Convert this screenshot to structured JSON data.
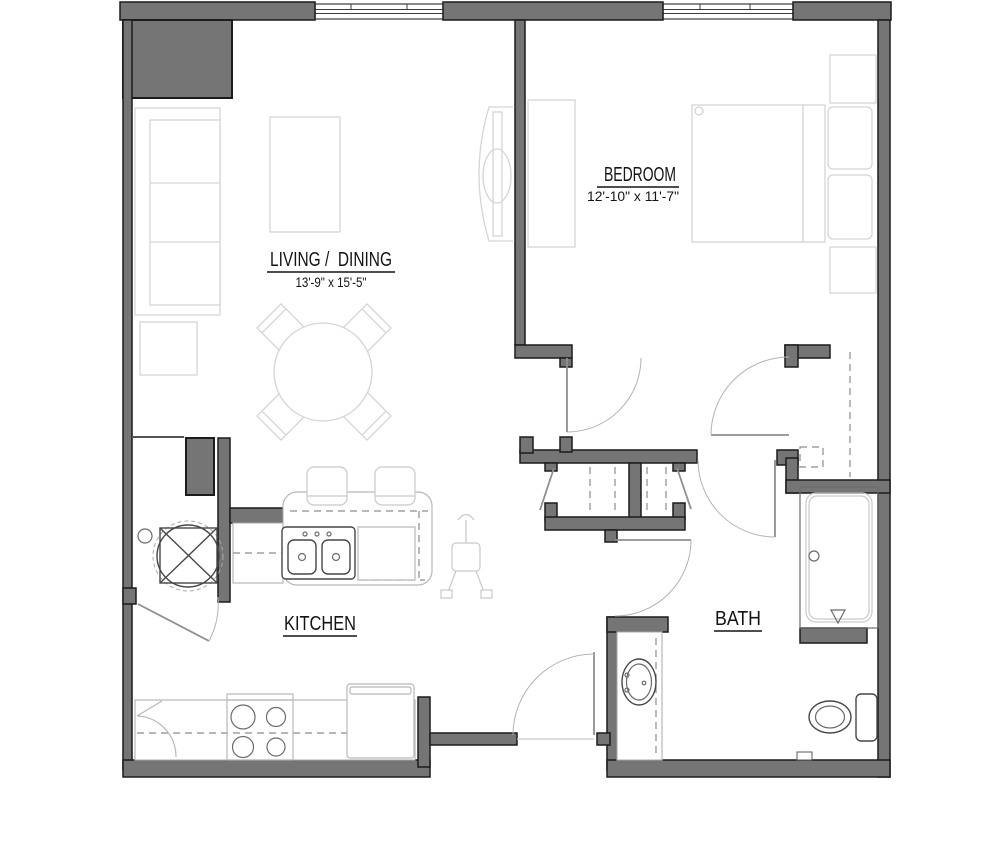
{
  "page": {
    "type": "apartment-floor-plan",
    "background": "#ffffff"
  },
  "colors": {
    "bg": "#ffffff",
    "wall": "#757575",
    "wall_stroke": "#1c1c1c",
    "furniture": "#d5d5d5",
    "fixture": "#474747",
    "door": "#b3b3b3",
    "dash": "#8d8d8d",
    "label": "#141414"
  },
  "rooms": [
    {
      "id": "living-dining",
      "label": "LIVING /  DINING",
      "dims": "13'-9\" x 15'-5\""
    },
    {
      "id": "bedroom",
      "label": "BEDROOM",
      "dims": "12'-10\" x 11'-7\""
    },
    {
      "id": "kitchen",
      "label": "KITCHEN",
      "dims": ""
    },
    {
      "id": "bath",
      "label": "BATH",
      "dims": ""
    }
  ],
  "fixtures": [
    "sofa",
    "end-table",
    "coffee-table",
    "tv-console",
    "round-dining-table",
    "dining-chair",
    "dresser",
    "double-bed",
    "pillow",
    "nightstand",
    "closet-rod",
    "stacked-washer-dryer",
    "double-basin-sink",
    "dishwasher",
    "bar-stool",
    "high-chair",
    "corner-cabinet",
    "range-stove",
    "refrigerator",
    "vanity-sink",
    "shower",
    "toilet",
    "hinged-door",
    "bifold-door",
    "window"
  ]
}
